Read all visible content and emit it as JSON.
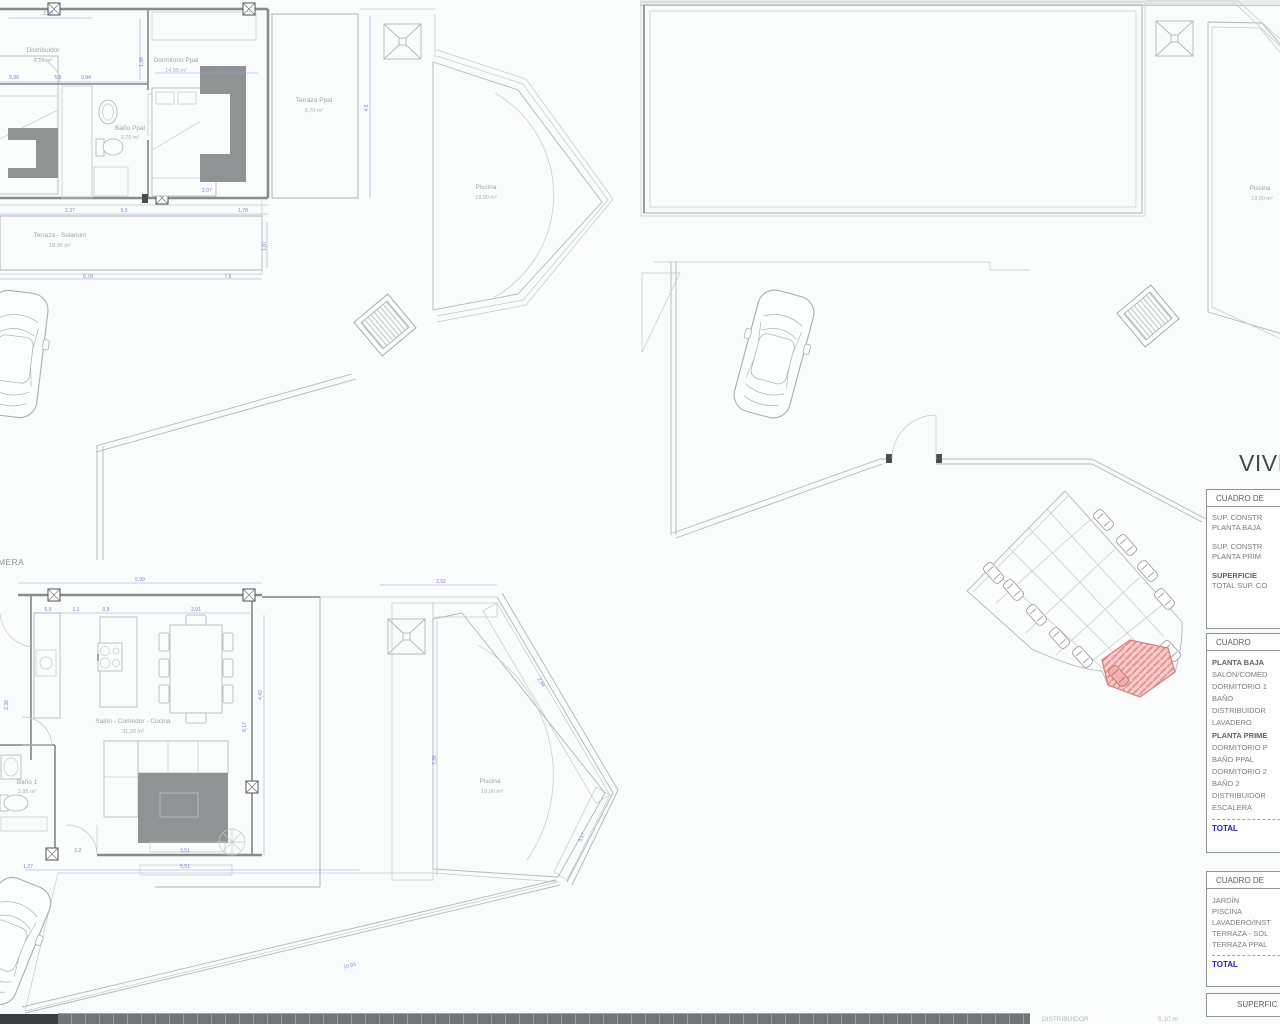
{
  "document": {
    "type": "architectural floor plan sheet",
    "language": "es"
  },
  "colors": {
    "background": "#fafbfb",
    "line_light": "#c6c9cb",
    "wall_gray": "#878c8f",
    "dim_blue": "#7e83d6",
    "label_gray": "#a2a6a9",
    "rug_dark": "#909394",
    "plot_red_fill": "#f5cac8",
    "plot_red_line": "#d87c7a",
    "total_blue": "#2424c4",
    "table_border": "#8f9496"
  },
  "plans": {
    "primera": {
      "caption_visible": "MERA",
      "rooms": {
        "distribuidor": {
          "name": "Distribuidor",
          "area": "4,10 m²"
        },
        "dormitorio_ppal": {
          "name": "Dormitorio Ppal",
          "area": "14,95 m²"
        },
        "bano_ppal": {
          "name": "Baño Ppal",
          "area": "3,75 m²"
        },
        "terraza_ppal": {
          "name": "Terraza Ppal",
          "area": "9,70 m²"
        },
        "terraza_solarium": {
          "name": "Terraza - Solarium",
          "area": "18,95 m²"
        },
        "piscina": {
          "name": "Piscina",
          "area": "19,00 m²"
        }
      }
    },
    "cubierta": {
      "rooms": {
        "piscina": {
          "name": "Piscina",
          "area": "19,00 m²"
        }
      }
    },
    "baja": {
      "rooms": {
        "salon": {
          "name": "Salón - Comedor - Cocina",
          "area": "31,30 m²"
        },
        "bano1": {
          "name": "Baño 1",
          "area": "3,95 m²"
        },
        "piscina": {
          "name": "Piscina",
          "area": "19,00 m²"
        }
      }
    }
  },
  "dims": {
    "p1": [
      "2,43",
      "6,16",
      "5,98",
      "5,8",
      "0,94",
      "1,98",
      "4,5",
      "2,37",
      "9,3",
      "1,78",
      "6,78",
      "7,6",
      "1,87",
      "2,07"
    ],
    "pb": [
      "5,99",
      "5,5",
      "1,1",
      "0,9",
      "2,91",
      "2,92",
      "4,42",
      "8,17",
      "7,36",
      "3,51",
      "1,2",
      "5,51",
      "1,27",
      "2,94",
      "3,17",
      "10,93",
      "2,38"
    ]
  },
  "panel": {
    "title": "VIVI",
    "table1": {
      "header": "CUADRO DE",
      "rows": [
        {
          "line1": "SUP. CONSTR",
          "line2": "PLANTA BAJA"
        },
        {
          "line1": "SUP. CONSTR",
          "line2": "PLANTA PRIM"
        },
        {
          "line1": "SUPERFICIE",
          "line2": "TOTAL SUP. CO"
        }
      ]
    },
    "table2": {
      "header": "CUADRO",
      "rows": [
        "PLANTA BAJA",
        "SALÓN/COMED",
        "DORMITORIO 1",
        "BAÑO",
        "DISTRIBUIDOR",
        "LAVADERO",
        "PLANTA PRIME",
        "DORMITORIO P",
        "BAÑO PPAL",
        "DORMITORIO 2",
        "BAÑO 2",
        "DISTRIBUIDOR",
        "ESCALERA"
      ],
      "total": "TOTAL"
    },
    "table3": {
      "header": "CUADRO DE",
      "rows": [
        "JARDÍN",
        "PISCINA",
        "LAVADERO/INST",
        "TERRAZA - SOL",
        "TERRAZA PPAL"
      ],
      "total": "TOTAL"
    },
    "table4": {
      "header": "SUPERFIC"
    }
  },
  "bottom_strip": {
    "label1": "DISTRIBUIDOR",
    "label2": "5,10 m"
  }
}
